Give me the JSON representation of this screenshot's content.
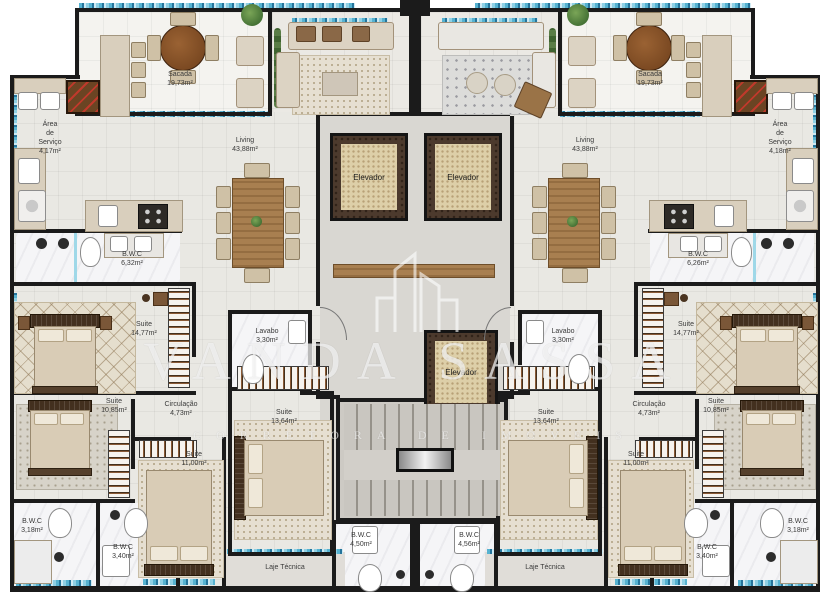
{
  "watermark": {
    "title": "VANDA SASSA",
    "subtitle": "CORRETORA DE IMÓVEIS"
  },
  "labels": {
    "sacada_l": {
      "name": "Sacada",
      "area": "19,73m²"
    },
    "sacada_r": {
      "name": "Sacada",
      "area": "19,73m²"
    },
    "living_l": {
      "name": "Living",
      "area": "43,88m²"
    },
    "living_r": {
      "name": "Living",
      "area": "43,88m²"
    },
    "servico_l": {
      "name": "Área\nde\nServiço",
      "area": "4,17m²"
    },
    "servico_r": {
      "name": "Área\nde\nServiço",
      "area": "4,18m²"
    },
    "bwc_master_l": {
      "name": "B.W.C",
      "area": "6,32m²"
    },
    "bwc_master_r": {
      "name": "B.W.C",
      "area": "6,26m²"
    },
    "suite14_l": {
      "name": "Suite",
      "area": "14,77m²"
    },
    "suite14_r": {
      "name": "Suite",
      "area": "14,77m²"
    },
    "lavabo_l": {
      "name": "Lavabo",
      "area": "3,30m²"
    },
    "lavabo_r": {
      "name": "Lavabo",
      "area": "3,30m²"
    },
    "suite13_l": {
      "name": "Suite",
      "area": "13,64m²"
    },
    "suite13_r": {
      "name": "Suite",
      "area": "13,64m²"
    },
    "circulacao_l": {
      "name": "Circulação",
      "area": "4,73m²"
    },
    "circulacao_r": {
      "name": "Circulação",
      "area": "4,73m²"
    },
    "suite10_l": {
      "name": "Suite",
      "area": "10,85m²"
    },
    "suite10_r": {
      "name": "Suite",
      "area": "10,85m²"
    },
    "suite11_l": {
      "name": "Suite",
      "area": "11,00m²"
    },
    "suite11_r": {
      "name": "Suite",
      "area": "11,00m²"
    },
    "bwc318_l": {
      "name": "B.W.C",
      "area": "3,18m²"
    },
    "bwc318_r": {
      "name": "B.W.C",
      "area": "3,18m²"
    },
    "bwc340_l": {
      "name": "B.W.C",
      "area": "3,40m²"
    },
    "bwc340_r": {
      "name": "B.W.C",
      "area": "3,40m²"
    },
    "bwc_center_l": {
      "name": "B.W.C",
      "area": "4,50m²"
    },
    "bwc_center_r": {
      "name": "B.W.C",
      "area": "4,56m²"
    },
    "laje_l": {
      "name": "Laje Técnica"
    },
    "laje_r": {
      "name": "Laje Técnica"
    },
    "elevador_1": {
      "name": "Elevador"
    },
    "elevador_2": {
      "name": "Elevador"
    },
    "elevador_3": {
      "name": "Elevador"
    }
  }
}
